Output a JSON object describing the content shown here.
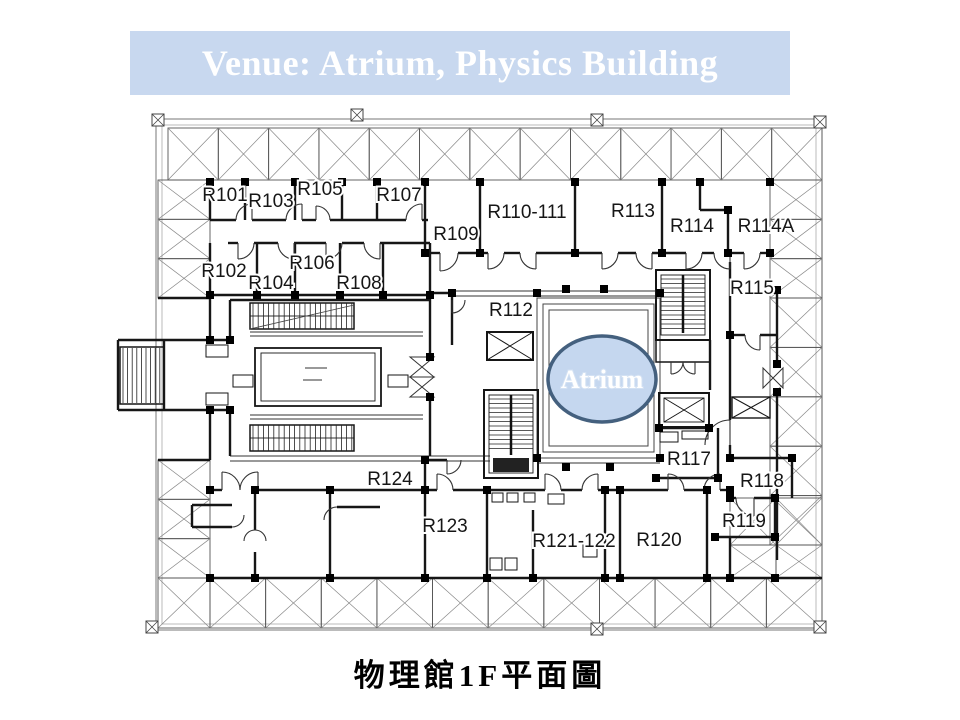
{
  "title": {
    "text": "Venue: Atrium, Physics Building"
  },
  "caption": {
    "text": "物理館1F平面圖"
  },
  "atrium": {
    "label": "Atrium",
    "cx": 602,
    "cy": 379,
    "rx": 54,
    "ry": 43,
    "label_y": 388
  },
  "colors": {
    "banner_bg": "#c8d8ef",
    "banner_text": "#ffffff",
    "atrium_fill": "#c5d7ef",
    "atrium_stroke": "#44607e",
    "atrium_text": "#ffffff",
    "plan_line": "#161616"
  },
  "rooms": [
    {
      "id": "R101",
      "x": 225,
      "y": 201
    },
    {
      "id": "R103",
      "x": 271,
      "y": 207
    },
    {
      "id": "R105",
      "x": 320,
      "y": 195
    },
    {
      "id": "R107",
      "x": 399,
      "y": 201
    },
    {
      "id": "R109",
      "x": 456,
      "y": 240
    },
    {
      "id": "R110-111",
      "x": 527,
      "y": 218
    },
    {
      "id": "R113",
      "x": 633,
      "y": 217
    },
    {
      "id": "R114",
      "x": 692,
      "y": 232
    },
    {
      "id": "R114A",
      "x": 766,
      "y": 232
    },
    {
      "id": "R102",
      "x": 224,
      "y": 277
    },
    {
      "id": "R104",
      "x": 271,
      "y": 289
    },
    {
      "id": "R106",
      "x": 312,
      "y": 269
    },
    {
      "id": "R108",
      "x": 359,
      "y": 289
    },
    {
      "id": "R115",
      "x": 752,
      "y": 294
    },
    {
      "id": "R112",
      "x": 511,
      "y": 316
    },
    {
      "id": "R117",
      "x": 689,
      "y": 465
    },
    {
      "id": "R118",
      "x": 762,
      "y": 487
    },
    {
      "id": "R119",
      "x": 744,
      "y": 527
    },
    {
      "id": "R124",
      "x": 390,
      "y": 485
    },
    {
      "id": "R123",
      "x": 445,
      "y": 532
    },
    {
      "id": "R121-122",
      "x": 574,
      "y": 547
    },
    {
      "id": "R120",
      "x": 659,
      "y": 546
    }
  ]
}
